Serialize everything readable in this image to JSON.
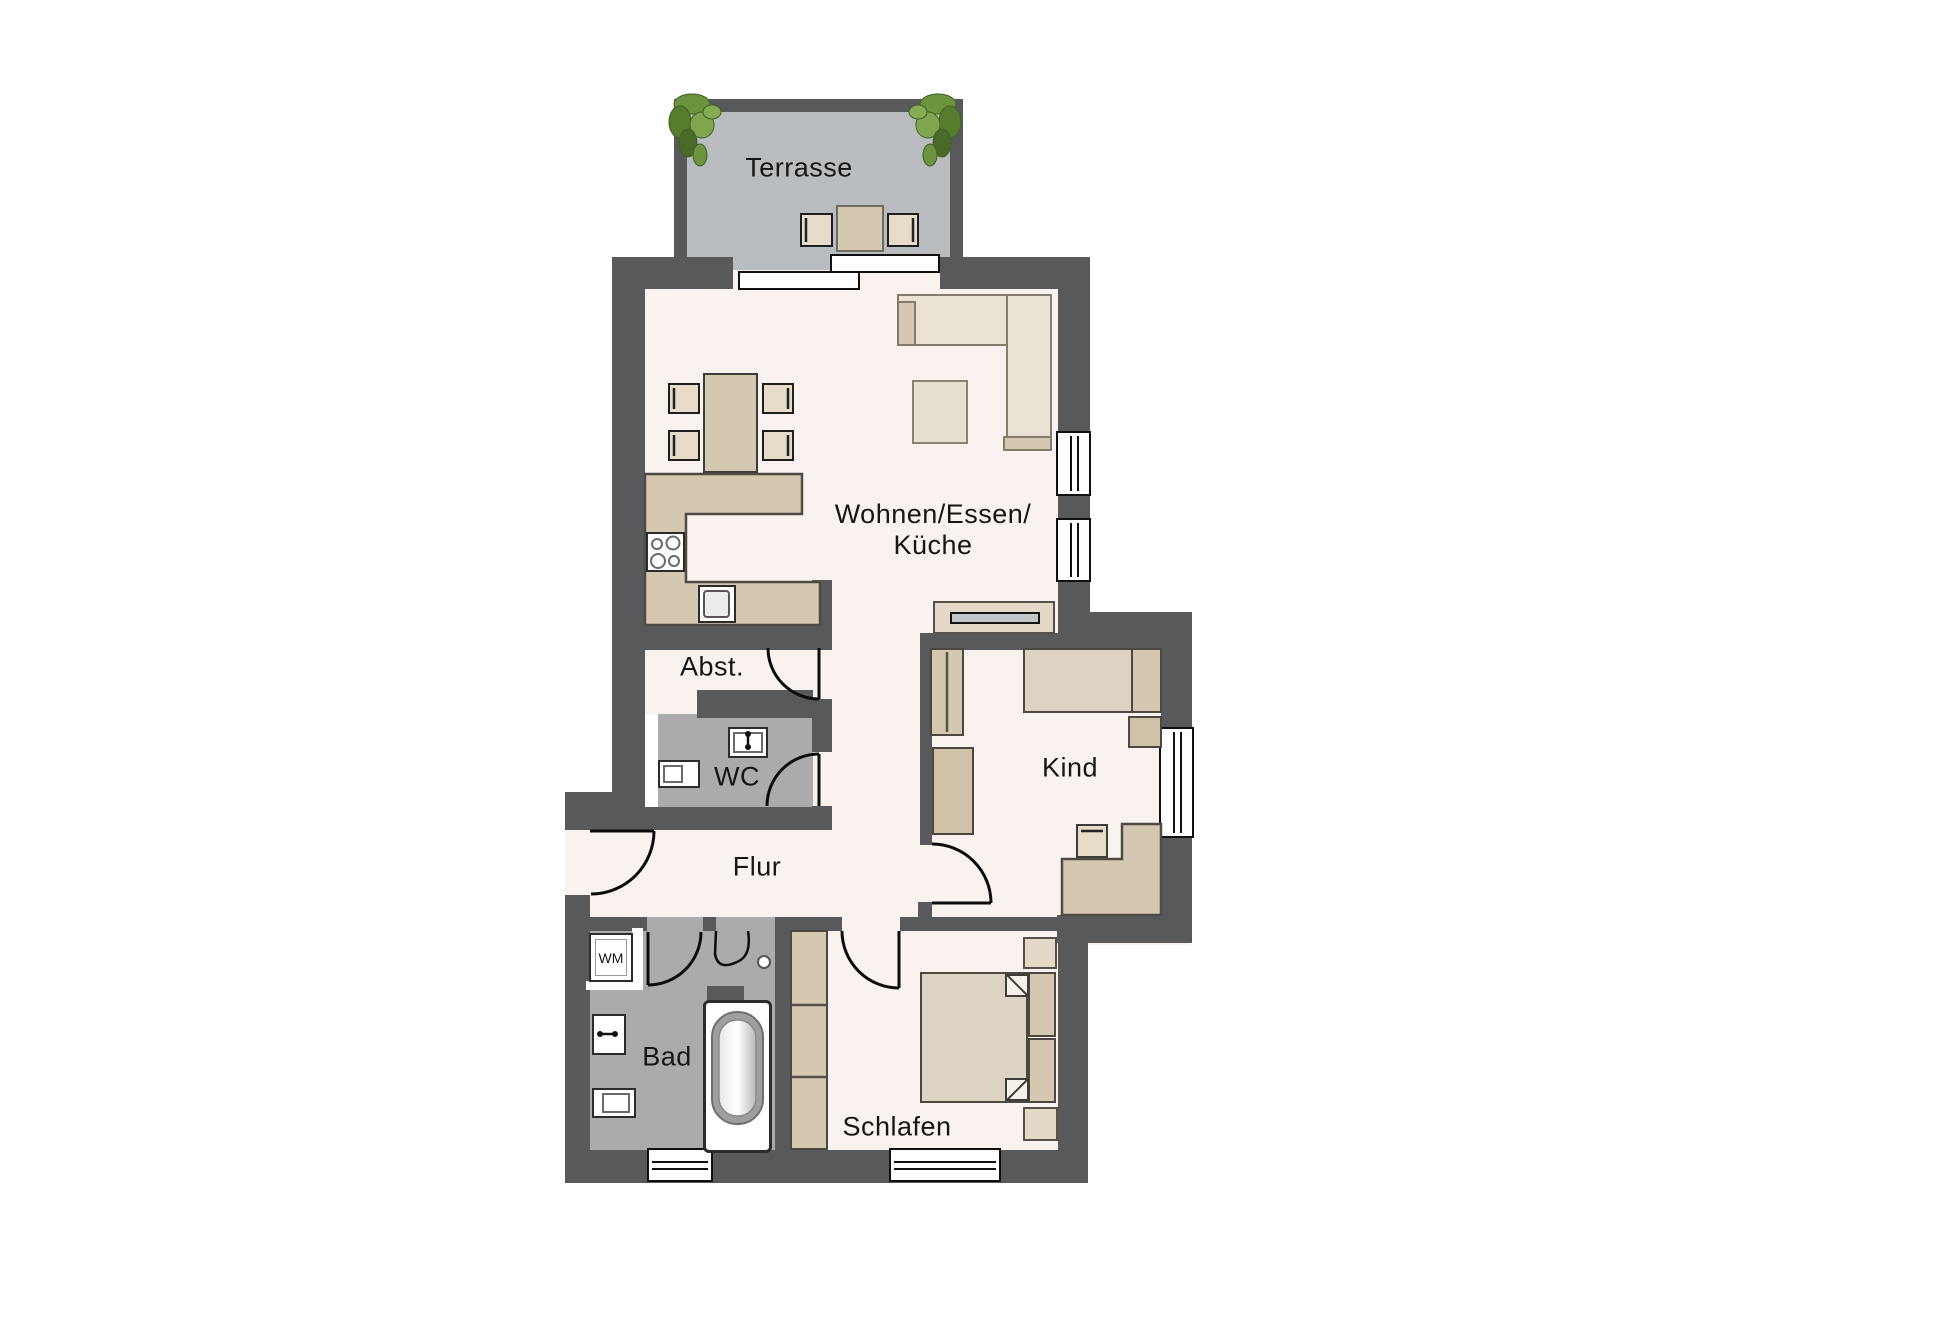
{
  "title": "Apartment floor plan",
  "labels": {
    "terrace": "Terrasse",
    "living_line1": "Wohnen/Essen/",
    "living_line2": "Küche",
    "storage": "Abst.",
    "wc": "WC",
    "hall": "Flur",
    "child": "Kind",
    "bath": "Bad",
    "bedroom": "Schlafen",
    "fridge": "KS",
    "washer": "WM"
  },
  "colors": {
    "wall": "#58595b",
    "floor": "#f9f2ee",
    "terrace_floor": "#b9bdbf",
    "wet_floor": "#ababad",
    "beige": "#d5c8b0",
    "beige_light": "#e6dcc9",
    "beige_dark": "#cfc2a9",
    "mattress": "#ddd3c3",
    "sofa": "#eae2d3",
    "furline": "#4d483f",
    "tv": "#c2c7ca",
    "plant_green": "#6b9340",
    "plant_dark": "#3f6023",
    "text": "#161616"
  },
  "legend": {
    "rooms": [
      "Terrasse",
      "Wohnen/Essen/Küche",
      "Abst.",
      "WC",
      "Flur",
      "Kind",
      "Bad",
      "Schlafen"
    ],
    "appliances": [
      "KS",
      "WM"
    ]
  }
}
